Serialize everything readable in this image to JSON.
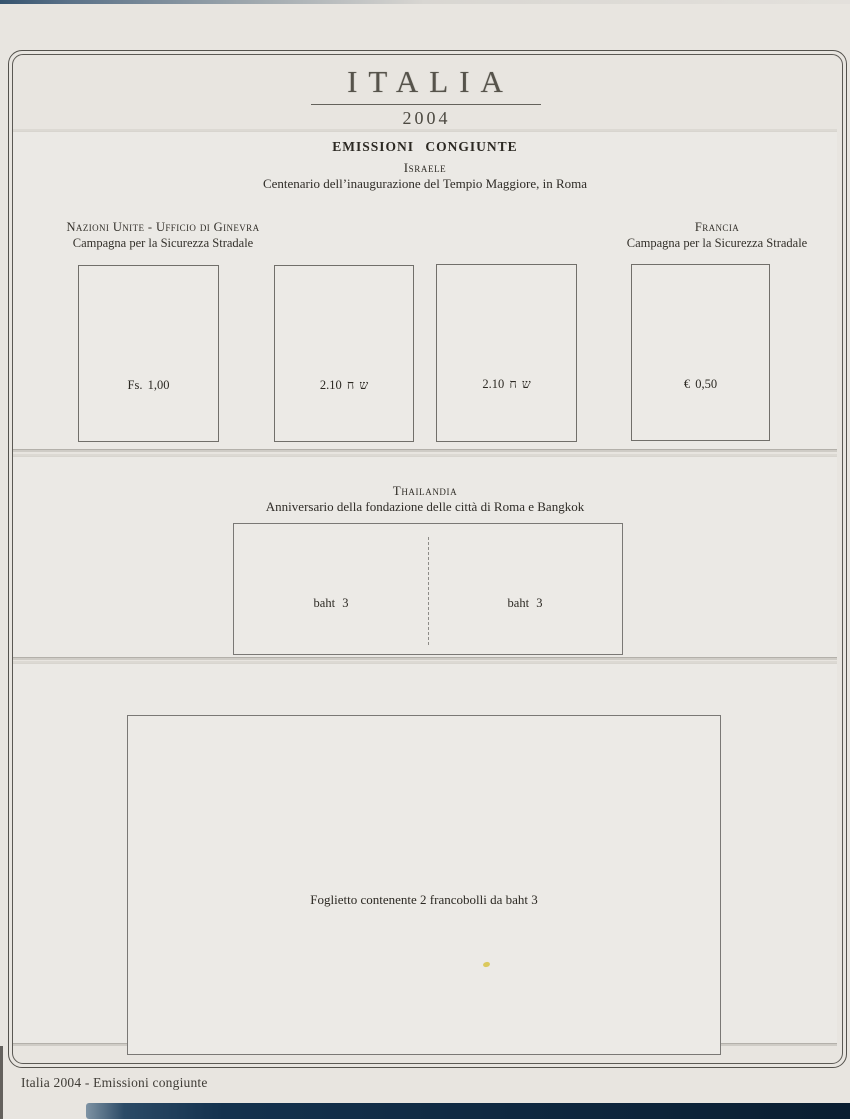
{
  "header": {
    "title": "ITALIA",
    "year": "2004"
  },
  "page_heading": "EMISSIONI CONGIUNTE",
  "israele": {
    "country": "Israele",
    "description": "Centenario dell’inaugurazione del Tempio Maggiore, in Roma",
    "left_label": {
      "line1": "Nazioni Unite - Ufficio di Ginevra",
      "line2": "Campagna per la Sicurezza Stradale"
    },
    "right_label": {
      "line1": "Francia",
      "line2": "Campagna per la Sicurezza Stradale"
    },
    "stamps": [
      {
        "value": "Fs. 1,00"
      },
      {
        "value": "ש ח 2.10"
      },
      {
        "value": "ש ח 2.10"
      },
      {
        "value": "€ 0,50"
      }
    ]
  },
  "thailandia": {
    "country": "Thailandia",
    "description": "Anniversario della fondazione delle città di Roma e Bangkok",
    "stamps": [
      {
        "value": "baht 3"
      },
      {
        "value": "baht 3"
      }
    ]
  },
  "foglietto": {
    "caption": "Foglietto contenente 2 francobolli da baht 3"
  },
  "footer": "Italia 2004 - Emissioni congiunte",
  "colors": {
    "page_background": "#e8e5e0",
    "panel_background": "#ebe9e5",
    "frame_line": "#54524d",
    "binder_blue": "#14324e",
    "artifact_yellow": "#d9c54e",
    "text": "#2c2923"
  }
}
